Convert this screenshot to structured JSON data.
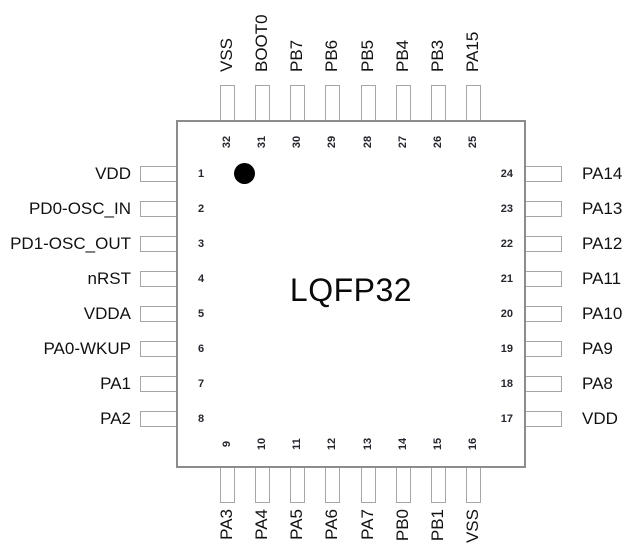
{
  "package": {
    "name": "LQFP32"
  },
  "pins": {
    "top": [
      {
        "num": "32",
        "label": "VSS"
      },
      {
        "num": "31",
        "label": "BOOT0"
      },
      {
        "num": "30",
        "label": "PB7"
      },
      {
        "num": "29",
        "label": "PB6"
      },
      {
        "num": "28",
        "label": "PB5"
      },
      {
        "num": "27",
        "label": "PB4"
      },
      {
        "num": "26",
        "label": "PB3"
      },
      {
        "num": "25",
        "label": "PA15"
      }
    ],
    "left": [
      {
        "num": "1",
        "label": "VDD"
      },
      {
        "num": "2",
        "label": "PD0-OSC_IN"
      },
      {
        "num": "3",
        "label": "PD1-OSC_OUT"
      },
      {
        "num": "4",
        "label": "nRST"
      },
      {
        "num": "5",
        "label": "VDDA"
      },
      {
        "num": "6",
        "label": "PA0-WKUP"
      },
      {
        "num": "7",
        "label": "PA1"
      },
      {
        "num": "8",
        "label": "PA2"
      }
    ],
    "right": [
      {
        "num": "24",
        "label": "PA14"
      },
      {
        "num": "23",
        "label": "PA13"
      },
      {
        "num": "22",
        "label": "PA12"
      },
      {
        "num": "21",
        "label": "PA11"
      },
      {
        "num": "20",
        "label": "PA10"
      },
      {
        "num": "19",
        "label": "PA9"
      },
      {
        "num": "18",
        "label": "PA8"
      },
      {
        "num": "17",
        "label": "VDD"
      }
    ],
    "bottom": [
      {
        "num": "9",
        "label": "PA3"
      },
      {
        "num": "10",
        "label": "PA4"
      },
      {
        "num": "11",
        "label": "PA5"
      },
      {
        "num": "12",
        "label": "PA6"
      },
      {
        "num": "13",
        "label": "PA7"
      },
      {
        "num": "14",
        "label": "PB0"
      },
      {
        "num": "15",
        "label": "PB1"
      },
      {
        "num": "16",
        "label": "VSS"
      }
    ]
  },
  "colors": {
    "body_border": "#8c8c8c",
    "stub_border": "#a6a6a6",
    "pin1_dot": "#000000",
    "text": "#111111",
    "background": "#ffffff"
  }
}
